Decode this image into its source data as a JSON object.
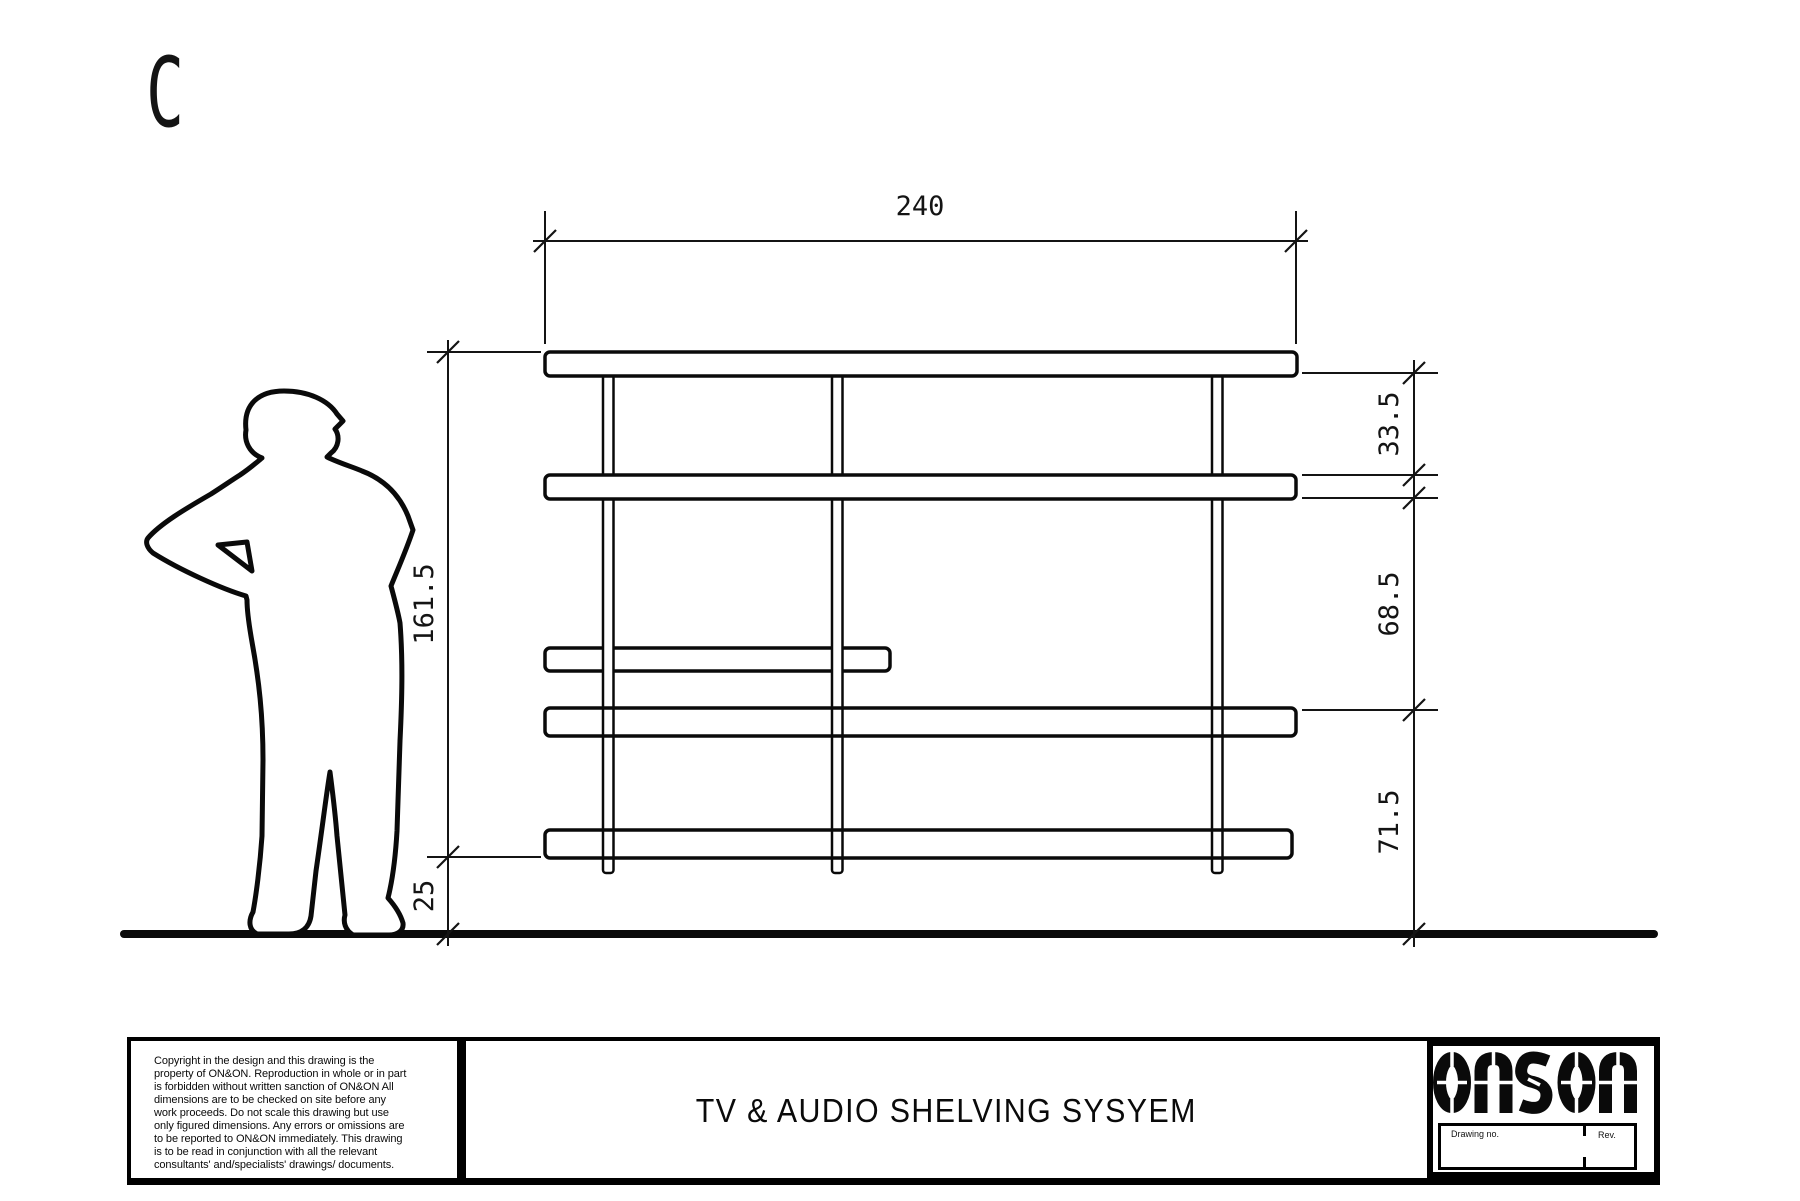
{
  "page": {
    "view_label": "C"
  },
  "drawing": {
    "subject": "shelving-unit-elevation",
    "dimensions": {
      "overall_width": "240",
      "overall_height": "161.5",
      "base_height": "25",
      "top_gap": "33.5",
      "middle_gap": "68.5",
      "bottom_gap": "71.5"
    }
  },
  "title_block": {
    "copyright_lines": [
      "Copyright in the design and this drawing is the",
      "property of ON&ON. Reproduction in whole or in part",
      "is forbidden without written sanction of ON&ON All",
      "dimensions are to be checked on site before any",
      "work proceeds. Do not scale this drawing but use",
      "only figured dimensions. Any errors or omissions are",
      "to be reported to ON&ON immediately. This drawing",
      "is to be read in conjunction with all the relevant",
      "consultants' and/specialists' drawings/ documents."
    ],
    "title": "TV & AUDIO SHELVING SYSYEM",
    "logo_text": "on&on",
    "drawing_no_label": "Drawing no.",
    "rev_label": "Rev."
  }
}
